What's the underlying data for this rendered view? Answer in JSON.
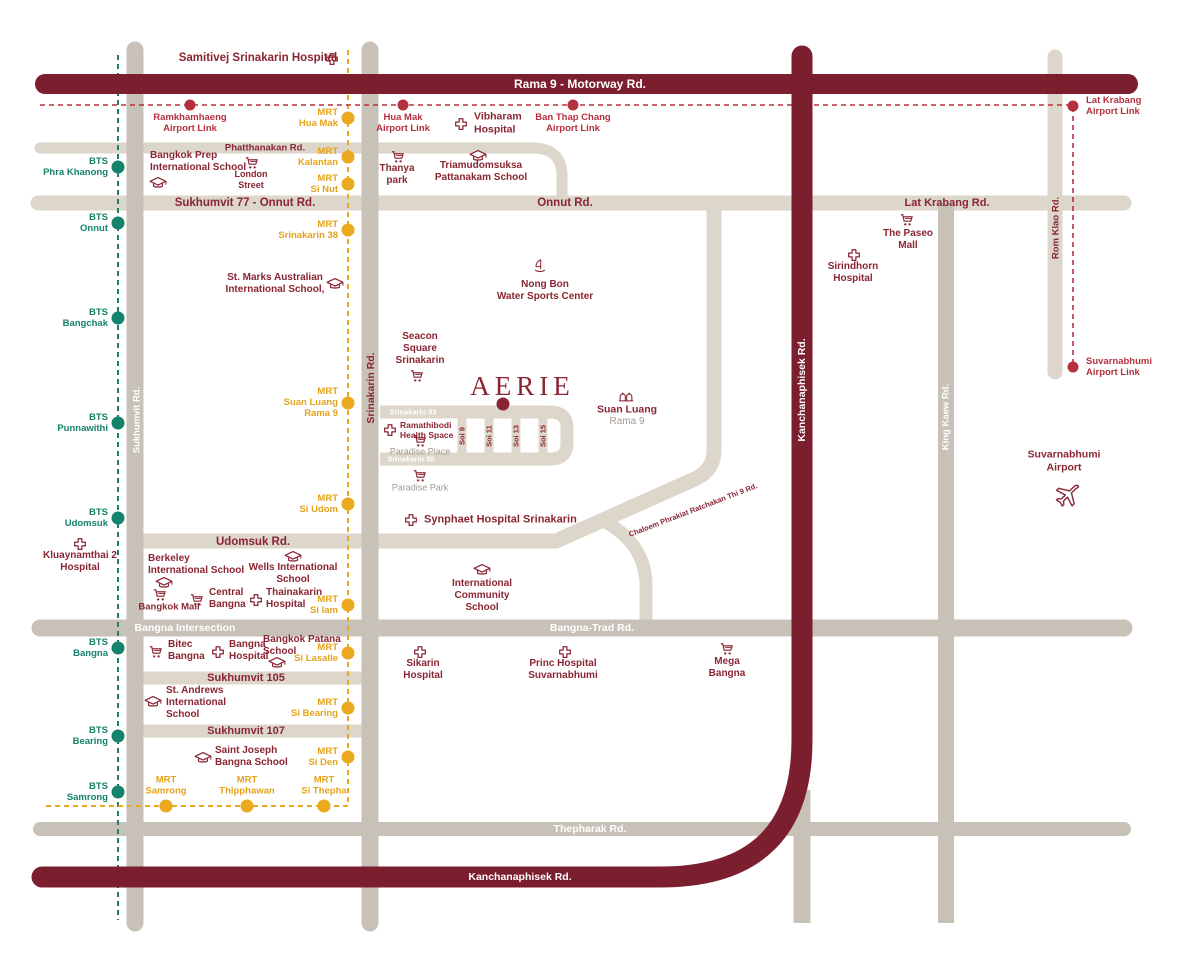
{
  "page_title": "AERIE Location Map",
  "colors": {
    "road_light": "#ddd6cb",
    "road_gray": "#c8c1b8",
    "road_dark": "#7b1e2d",
    "bts_line": "#15826a",
    "mrt_line": "#eaa91f",
    "airport_line": "#b5303e",
    "poi_text": "#8a2533",
    "muted_text": "#a49a91"
  },
  "road_labels": [
    {
      "id": "rama9",
      "label": "Rama 9 - Motorway Rd.",
      "x": 580,
      "y": 84,
      "color": "white",
      "size": 12
    },
    {
      "id": "phatthanakan",
      "label": "Phatthanakan Rd.",
      "x": 265,
      "y": 148,
      "color": "maroon",
      "size": 9.5
    },
    {
      "id": "sukhumvit77",
      "label": "Sukhumvit 77 - Onnut Rd.",
      "x": 245,
      "y": 203,
      "color": "maroon",
      "size": 11.5
    },
    {
      "id": "onnut",
      "label": "Onnut Rd.",
      "x": 565,
      "y": 203,
      "color": "maroon",
      "size": 11.5
    },
    {
      "id": "lat-krabang",
      "label": "Lat Krabang Rd.",
      "x": 947,
      "y": 203,
      "color": "maroon",
      "size": 11
    },
    {
      "id": "udomsuk",
      "label": "Udomsuk Rd.",
      "x": 253,
      "y": 542,
      "color": "maroon",
      "size": 11.5
    },
    {
      "id": "sukhumvit-105",
      "label": "Sukhumvit 105",
      "x": 246,
      "y": 678,
      "color": "maroon",
      "size": 11
    },
    {
      "id": "sukhumvit-107",
      "label": "Sukhumvit 107",
      "x": 246,
      "y": 731,
      "color": "maroon",
      "size": 11
    },
    {
      "id": "bangna-intersection",
      "label": "Bangna Intersection",
      "x": 185,
      "y": 628,
      "color": "white",
      "size": 10.5
    },
    {
      "id": "bangna-trad",
      "label": "Bangna-Trad Rd.",
      "x": 592,
      "y": 628,
      "color": "white",
      "size": 10.5
    },
    {
      "id": "thepharak",
      "label": "Thepharak Rd.",
      "x": 590,
      "y": 829,
      "color": "white",
      "size": 10.5
    },
    {
      "id": "kanchanaphisek-south",
      "label": "Kanchanaphisek Rd.",
      "x": 520,
      "y": 877,
      "color": "white",
      "size": 10.5
    },
    {
      "id": "srinakarin-53",
      "label": "Srinakarin 53",
      "x": 413,
      "y": 412,
      "color": "white",
      "size": 7.5
    },
    {
      "id": "srinakarin-55",
      "label": "Srinakarin 55",
      "x": 411,
      "y": 459,
      "color": "white",
      "size": 7.5
    },
    {
      "id": "soi-9",
      "label": "Soi 9",
      "x": 462,
      "y": 436,
      "color": "maroon",
      "size": 7.5,
      "rot": -90
    },
    {
      "id": "soi-11",
      "label": "Soi 11",
      "x": 489,
      "y": 436,
      "color": "maroon",
      "size": 7.5,
      "rot": -90
    },
    {
      "id": "soi-13",
      "label": "Soi 13",
      "x": 516,
      "y": 436,
      "color": "maroon",
      "size": 7.5,
      "rot": -90
    },
    {
      "id": "soi-15",
      "label": "Soi 15",
      "x": 543,
      "y": 436,
      "color": "maroon",
      "size": 7.5,
      "rot": -90
    },
    {
      "id": "srinakarin-rd",
      "label": "Srinakarin Rd.",
      "x": 371,
      "y": 388,
      "color": "maroon",
      "size": 10.5,
      "rot": -90
    },
    {
      "id": "sukhumvit-rd",
      "label": "Sukhumvit Rd.",
      "x": 137,
      "y": 420,
      "color": "white",
      "size": 9.5,
      "rot": -90
    },
    {
      "id": "kanchanaphisek-vertical",
      "label": "Kanchanaphisek Rd.",
      "x": 802,
      "y": 390,
      "color": "white",
      "size": 10.5,
      "rot": -90
    },
    {
      "id": "king-kaew",
      "label": "King Kaew Rd.",
      "x": 946,
      "y": 417,
      "color": "white",
      "size": 9.5,
      "rot": -90
    },
    {
      "id": "rom-klao",
      "label": "Rom Klao Rd.",
      "x": 1056,
      "y": 228,
      "color": "maroon",
      "size": 9.5,
      "rot": -90
    },
    {
      "id": "chaloem-phrakiat",
      "label": "Chaloem Phrakiat Ratchakan Thi 9 Rd.",
      "x": 693,
      "y": 510,
      "color": "maroon",
      "size": 7.5,
      "rot": -21
    }
  ],
  "stations": {
    "bts": [
      {
        "id": "phra-khanong",
        "label": "BTS\nPhra Khanong",
        "x": 118,
        "y": 167,
        "lx": 108,
        "ly": 167,
        "align": "right"
      },
      {
        "id": "onnut",
        "label": "BTS\nOnnut",
        "x": 118,
        "y": 223,
        "lx": 108,
        "ly": 223,
        "align": "right"
      },
      {
        "id": "bangchak",
        "label": "BTS\nBangchak",
        "x": 118,
        "y": 318,
        "lx": 108,
        "ly": 318,
        "align": "right"
      },
      {
        "id": "punnawithi",
        "label": "BTS\nPunnawithi",
        "x": 118,
        "y": 423,
        "lx": 108,
        "ly": 423,
        "align": "right"
      },
      {
        "id": "udomsuk",
        "label": "BTS\nUdomsuk",
        "x": 118,
        "y": 518,
        "lx": 108,
        "ly": 518,
        "align": "right"
      },
      {
        "id": "bangna",
        "label": "BTS\nBangna",
        "x": 118,
        "y": 648,
        "lx": 108,
        "ly": 648,
        "align": "right"
      },
      {
        "id": "bearing",
        "label": "BTS\nBearing",
        "x": 118,
        "y": 736,
        "lx": 108,
        "ly": 736,
        "align": "right"
      },
      {
        "id": "samrong",
        "label": "BTS\nSamrong",
        "x": 118,
        "y": 792,
        "lx": 108,
        "ly": 792,
        "align": "right"
      }
    ],
    "mrt": [
      {
        "id": "hua-mak",
        "label": "MRT\nHua Mak",
        "x": 348,
        "y": 118,
        "lx": 338,
        "ly": 118,
        "align": "right"
      },
      {
        "id": "kalantan",
        "label": "MRT\nKalantan",
        "x": 348,
        "y": 157,
        "lx": 338,
        "ly": 157,
        "align": "right"
      },
      {
        "id": "si-nut",
        "label": "MRT\nSi Nut",
        "x": 348,
        "y": 184,
        "lx": 338,
        "ly": 184,
        "align": "right"
      },
      {
        "id": "srinakarin-38",
        "label": "MRT\nSrinakarin 38",
        "x": 348,
        "y": 230,
        "lx": 338,
        "ly": 230,
        "align": "right"
      },
      {
        "id": "suan-luang-rama-9",
        "label": "MRT\nSuan Luang\nRama 9",
        "x": 348,
        "y": 403,
        "lx": 338,
        "ly": 403,
        "align": "right"
      },
      {
        "id": "si-udom",
        "label": "MRT\nSi Udom",
        "x": 348,
        "y": 504,
        "lx": 338,
        "ly": 504,
        "align": "right"
      },
      {
        "id": "si-iam",
        "label": "MRT\nSi Iam",
        "x": 348,
        "y": 605,
        "lx": 338,
        "ly": 605,
        "align": "right"
      },
      {
        "id": "si-lasalle",
        "label": "MRT\nSi Lasalle",
        "x": 348,
        "y": 653,
        "lx": 338,
        "ly": 653,
        "align": "right"
      },
      {
        "id": "si-bearing",
        "label": "MRT\nSi Bearing",
        "x": 348,
        "y": 708,
        "lx": 338,
        "ly": 708,
        "align": "right"
      },
      {
        "id": "si-den",
        "label": "MRT\nSi Den",
        "x": 348,
        "y": 757,
        "lx": 338,
        "ly": 757,
        "align": "right"
      },
      {
        "id": "samrong",
        "label": "MRT\nSamrong",
        "x": 166,
        "y": 806,
        "lx": 166,
        "ly": 797,
        "align": "above"
      },
      {
        "id": "thipphawan",
        "label": "MRT\nThipphawan",
        "x": 247,
        "y": 806,
        "lx": 247,
        "ly": 797,
        "align": "above"
      },
      {
        "id": "si-thepha",
        "label": "MRT\nSi Thepha",
        "x": 324,
        "y": 806,
        "lx": 324,
        "ly": 797,
        "align": "above"
      }
    ],
    "airport_link": [
      {
        "id": "ramkhamhaeng",
        "label": "Ramkhamhaeng\nAirport Link",
        "x": 190,
        "y": 105,
        "lx": 190,
        "ly": 112,
        "align": "below"
      },
      {
        "id": "hua-mak",
        "label": "Hua Mak\nAirport Link",
        "x": 403,
        "y": 105,
        "lx": 403,
        "ly": 112,
        "align": "below"
      },
      {
        "id": "ban-thap-chang",
        "label": "Ban Thap Chang\nAirport Link",
        "x": 573,
        "y": 105,
        "lx": 573,
        "ly": 112,
        "align": "below"
      },
      {
        "id": "lat-krabang",
        "label": "Lat Krabang\nAirport Link",
        "x": 1073,
        "y": 106,
        "lx": 1086,
        "ly": 106,
        "align": "left"
      },
      {
        "id": "suvarnabhumi",
        "label": "Suvarnabhumi\nAirport Link",
        "x": 1073,
        "y": 367,
        "lx": 1086,
        "ly": 367,
        "align": "left"
      }
    ]
  },
  "markers": [
    {
      "id": "aerie-marker",
      "x": 503,
      "y": 404
    }
  ],
  "pois": [
    {
      "id": "aerie-logo",
      "label": "AERIE",
      "x": 520,
      "y": 386,
      "logo": true
    },
    {
      "id": "samitivej-srinakarin-hospital",
      "label": "Samitivej Srinakarin Hospital",
      "x": 258,
      "y": 59,
      "size": 11.5,
      "icon": "hospital-cross-icon",
      "ix": 332,
      "iy": 59
    },
    {
      "id": "bangkok-prep-international-school",
      "label": "Bangkok Prep\nInternational School",
      "x": 150,
      "y": 162,
      "align": "left",
      "icon": "grad-cap-icon",
      "ix": 158,
      "iy": 183
    },
    {
      "id": "london-street",
      "label": "London\nStreet",
      "x": 251,
      "y": 180,
      "size": 9,
      "icon": "cart-icon",
      "ix": 252,
      "iy": 163
    },
    {
      "id": "thanya-park",
      "label": "Thanya\npark",
      "x": 397,
      "y": 175,
      "icon": "cart-icon",
      "ix": 398,
      "iy": 157
    },
    {
      "id": "triamudomsuksa-pattanakam-school",
      "label": "Triamudomsuksa\nPattanakam School",
      "x": 481,
      "y": 172,
      "icon": "grad-cap-icon",
      "ix": 478,
      "iy": 156
    },
    {
      "id": "vibharam-hospital",
      "label": "Vibharam\nHospital",
      "x": 474,
      "y": 123,
      "align": "left",
      "size": 10.5,
      "icon": "hospital-cross-icon",
      "ix": 461,
      "iy": 124
    },
    {
      "id": "st-marks-australian-international-school",
      "label": "St. Marks Australian\nInternational School,",
      "x": 275,
      "y": 284,
      "icon": "grad-cap-icon",
      "ix": 335,
      "iy": 284
    },
    {
      "id": "seacon-square-srinakarin",
      "label": "Seacon\nSquare\nSrinakarin",
      "x": 420,
      "y": 349,
      "icon": "cart-icon",
      "ix": 417,
      "iy": 376
    },
    {
      "id": "nong-bon-water-sports-center",
      "label": "Nong Bon\nWater Sports Center",
      "x": 545,
      "y": 291,
      "icon": "windsurf-icon",
      "ix": 540,
      "iy": 266
    },
    {
      "id": "suan-luang",
      "label": "Suan Luang",
      "x": 627,
      "y": 410,
      "size": 10.5,
      "icon": "park-icon",
      "ix": 626,
      "iy": 396
    },
    {
      "id": "suan-luang-rama-9-sub",
      "label": "Rama 9",
      "x": 627,
      "y": 422,
      "size": 10,
      "muted": true
    },
    {
      "id": "ramathibodi-health-space",
      "label": "Ramathibodi\nHealth Space",
      "x": 400,
      "y": 430,
      "align": "left",
      "size": 8.5,
      "icon": "hospital-cross-icon",
      "ix": 390,
      "iy": 430
    },
    {
      "id": "paradise-place",
      "label": "Paradise Place",
      "x": 420,
      "y": 452,
      "size": 9,
      "muted": true,
      "icon": "cart-icon",
      "ix": 420,
      "iy": 441
    },
    {
      "id": "paradise-park",
      "label": "Paradise Park",
      "x": 420,
      "y": 488,
      "size": 9,
      "muted": true,
      "icon": "cart-icon",
      "ix": 420,
      "iy": 476
    },
    {
      "id": "synphaet-hospital-srinakarin",
      "label": "Synphaet Hospital Srinakarin",
      "x": 424,
      "y": 520,
      "align": "left",
      "size": 11,
      "icon": "hospital-cross-icon",
      "ix": 411,
      "iy": 520
    },
    {
      "id": "kluaynamthai-2-hospital",
      "label": "Kluaynamthai 2\nHospital",
      "x": 80,
      "y": 562,
      "icon": "hospital-cross-icon",
      "ix": 80,
      "iy": 544
    },
    {
      "id": "berkeley-international-school",
      "label": "Berkeley\nInternational School",
      "x": 148,
      "y": 565,
      "align": "left",
      "icon": "grad-cap-icon",
      "ix": 164,
      "iy": 583
    },
    {
      "id": "wells-international-school",
      "label": "Wells International\nSchool",
      "x": 293,
      "y": 574,
      "icon": "grad-cap-icon",
      "ix": 293,
      "iy": 557
    },
    {
      "id": "bangkok-mall",
      "label": "Bangkok Mall",
      "x": 169,
      "y": 607,
      "size": 9.5,
      "icon": "cart-icon",
      "ix": 160,
      "iy": 595
    },
    {
      "id": "central-bangna",
      "label": "Central\nBangna",
      "x": 209,
      "y": 599,
      "align": "left",
      "icon": "cart-icon",
      "ix": 197,
      "iy": 600
    },
    {
      "id": "thainakarin-hospital",
      "label": "Thainakarin\nHospital",
      "x": 266,
      "y": 599,
      "align": "left",
      "icon": "hospital-cross-icon",
      "ix": 256,
      "iy": 600
    },
    {
      "id": "bitec-bangna",
      "label": "Bitec\nBangna",
      "x": 168,
      "y": 651,
      "align": "left",
      "icon": "cart-icon",
      "ix": 156,
      "iy": 652
    },
    {
      "id": "bangna-hospital",
      "label": "Bangna\nHospital",
      "x": 229,
      "y": 651,
      "align": "left",
      "icon": "hospital-cross-icon",
      "ix": 218,
      "iy": 652
    },
    {
      "id": "bangkok-patana-school",
      "label": "Bangkok Patana\nSchool",
      "x": 263,
      "y": 646,
      "align": "left",
      "icon": "grad-cap-icon",
      "ix": 277,
      "iy": 663
    },
    {
      "id": "st-andrews-international-school",
      "label": "St. Andrews\nInternational\nSchool",
      "x": 166,
      "y": 703,
      "align": "left",
      "icon": "grad-cap-icon",
      "ix": 153,
      "iy": 702
    },
    {
      "id": "saint-joseph-bangna-school",
      "label": "Saint Joseph\nBangna School",
      "x": 215,
      "y": 757,
      "align": "left",
      "icon": "grad-cap-icon",
      "ix": 203,
      "iy": 758
    },
    {
      "id": "international-community-school",
      "label": "International\nCommunity\nSchool",
      "x": 482,
      "y": 596,
      "icon": "grad-cap-icon",
      "ix": 482,
      "iy": 570
    },
    {
      "id": "sikarin-hospital",
      "label": "Sikarin\nHospital",
      "x": 423,
      "y": 670,
      "icon": "hospital-cross-icon",
      "ix": 420,
      "iy": 652
    },
    {
      "id": "princ-hospital-suvarnabhumi",
      "label": "Princ Hospital\nSuvarnabhumi",
      "x": 563,
      "y": 670,
      "icon": "hospital-cross-icon",
      "ix": 565,
      "iy": 652
    },
    {
      "id": "mega-bangna",
      "label": "Mega\nBangna",
      "x": 727,
      "y": 668,
      "icon": "cart-icon",
      "ix": 727,
      "iy": 649
    },
    {
      "id": "the-paseo-mall",
      "label": "The Paseo\nMall",
      "x": 908,
      "y": 240,
      "icon": "cart-icon",
      "ix": 907,
      "iy": 220
    },
    {
      "id": "sirindhorn-hospital",
      "label": "Sirindhorn\nHospital",
      "x": 853,
      "y": 273,
      "icon": "hospital-cross-icon",
      "ix": 854,
      "iy": 255
    },
    {
      "id": "suvarnabhumi-airport",
      "label": "Suvarnabhumi\nAirport",
      "x": 1064,
      "y": 461,
      "size": 10.5,
      "icon": "plane-icon",
      "ix": 1066,
      "iy": 496
    }
  ]
}
